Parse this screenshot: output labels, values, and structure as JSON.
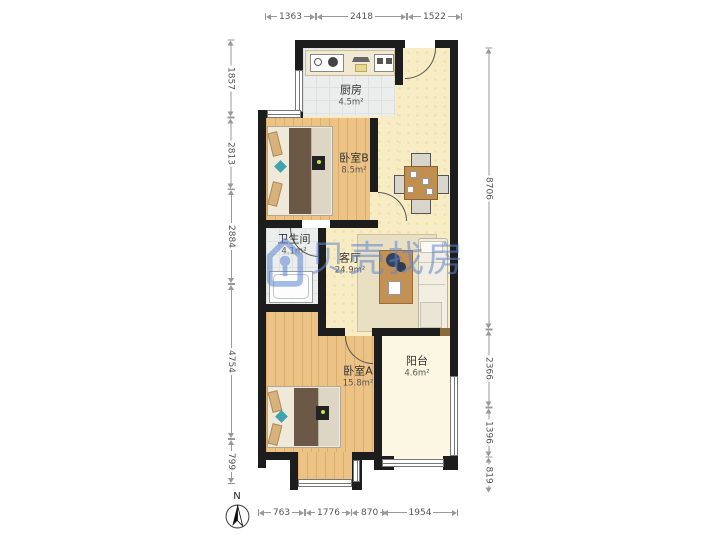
{
  "watermark": {
    "brand": "贝壳找房"
  },
  "compass": {
    "label": "N"
  },
  "rooms": {
    "kitchen": {
      "name": "厨房",
      "area": "4.5m²"
    },
    "bedroomB": {
      "name": "卧室B",
      "area": "8.5m²"
    },
    "bathroom": {
      "name": "卫生间",
      "area": "4.1m²"
    },
    "living": {
      "name": "客厅",
      "area": "24.9m²"
    },
    "bedroomA": {
      "name": "卧室A",
      "area": "15.8m²"
    },
    "balcony": {
      "name": "阳台",
      "area": "4.6m²"
    }
  },
  "dimensions": {
    "top": [
      "1363",
      "2418",
      "1522"
    ],
    "bottom": [
      "763",
      "1776",
      "870",
      "1954"
    ],
    "left": [
      "1857",
      "2813",
      "2884",
      "4754",
      "799"
    ],
    "right": [
      "8706",
      "2366",
      "1396",
      "819"
    ]
  },
  "colors": {
    "wall": "#1d1d1d",
    "wood_floor": "#ecc285",
    "living_floor": "#f7ecc4",
    "tile_floor": "#eceeed",
    "balcony_floor": "#fbf7e2",
    "watermark_blue": "#5d86d2"
  }
}
